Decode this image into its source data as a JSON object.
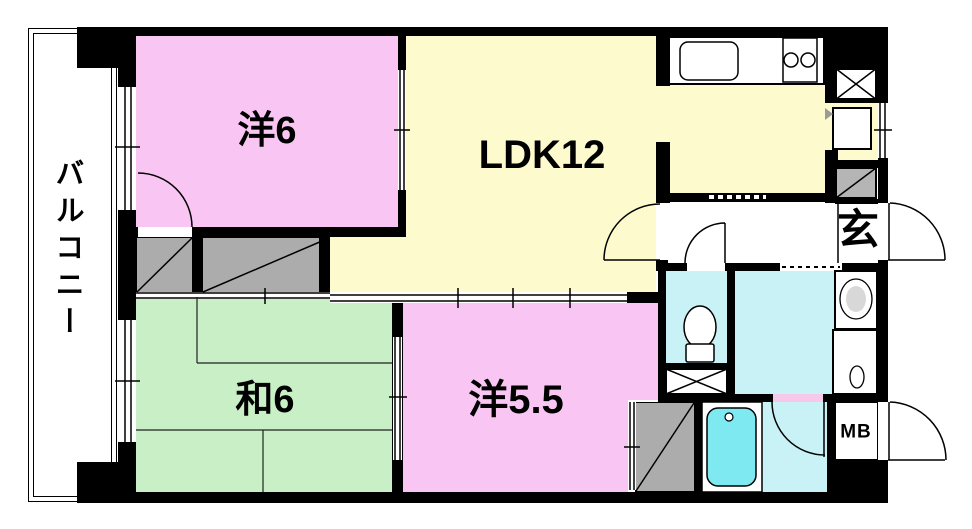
{
  "plan": {
    "type": "apartment-floor-plan",
    "labels": {
      "balcony": "バルコニー",
      "western_room_6": "洋6",
      "ldk": "LDK12",
      "japanese_room_6": "和6",
      "western_room_5_5": "洋5.5",
      "entrance": "玄",
      "meter_box": "MB"
    },
    "colors": {
      "wall": "#000000",
      "western_room": "#F9C6F3",
      "ldk": "#FDFACD",
      "japanese_room": "#C8EFC5",
      "wet_area": "#C9F2F6",
      "bathtub": "#7FE9F2",
      "closet": "#ACACAC",
      "basin": "#D8D8D8",
      "door_threshold": "#F6C9EA",
      "background": "#FFFFFF"
    },
    "fixtures": [
      "kitchen-sink",
      "stove-2-burner",
      "pipe-shaft",
      "refrigerator-space",
      "shoe-cabinet",
      "toilet",
      "washbasin",
      "washing-machine-space",
      "bathtub",
      "oshiire-closet",
      "closet",
      "tatami-6-mats"
    ]
  }
}
